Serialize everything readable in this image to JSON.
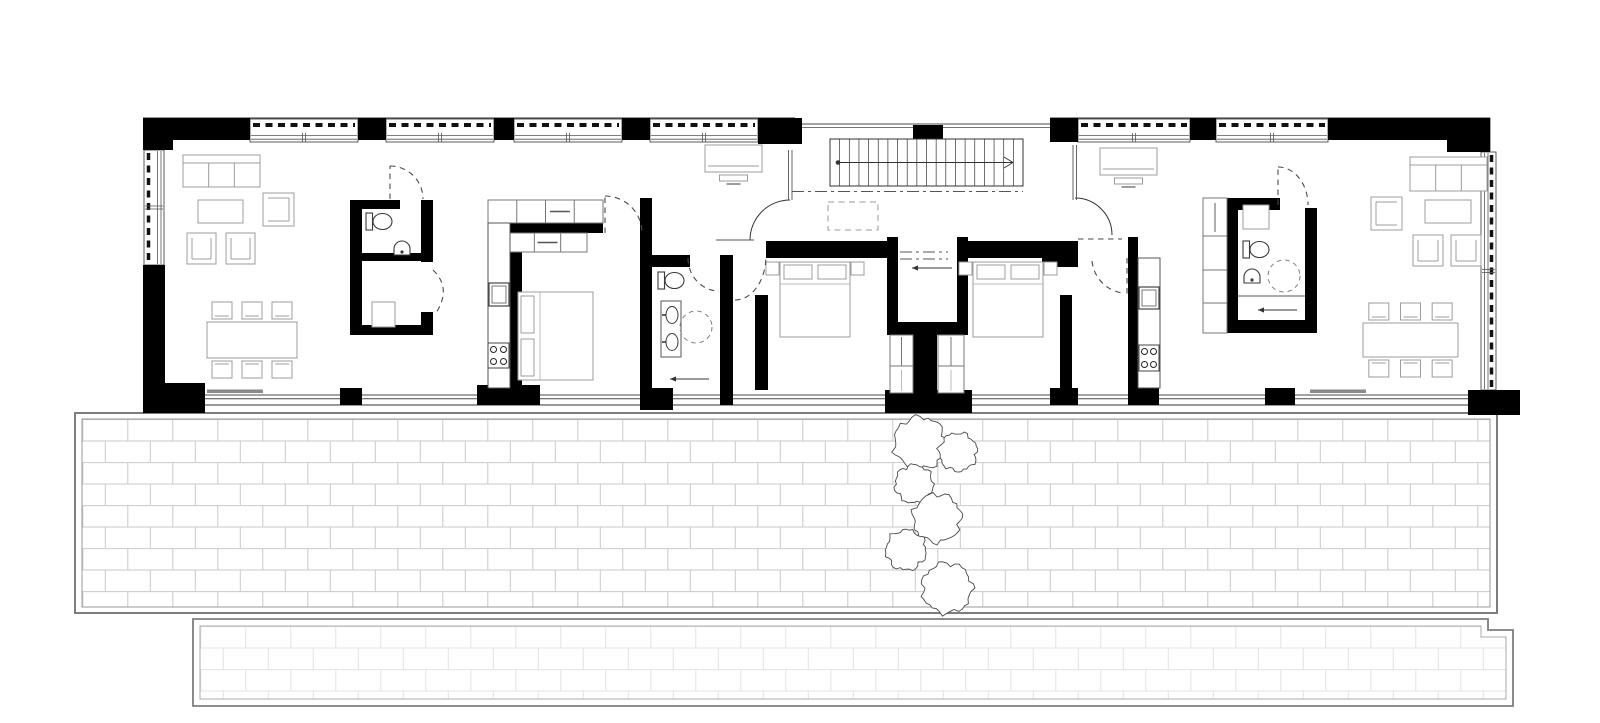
{
  "document": {
    "title": "Ground floor plan — two-unit bar building with brick terrace and trees",
    "drawing_style": "black poché walls, white floor, gray furniture linework, no text labels",
    "rooms": [
      "living-dining-west",
      "wc-west",
      "storage-west",
      "kitchen-west",
      "bedroom-west",
      "bathroom-west",
      "bedroom-center-west",
      "entry-hall",
      "staircase",
      "bedroom-center-east",
      "kitchen-east",
      "bathroom-east",
      "wardrobe-east",
      "living-dining-east",
      "terrace",
      "lower-terrace"
    ]
  },
  "canvas": {
    "width": 1600,
    "height": 723,
    "background": "#ffffff"
  },
  "palette": {
    "wall": "#000000",
    "edge": "#333333",
    "glass": "#4a4a4a",
    "thin": "#555555",
    "furniture": "#9c9c9c",
    "furnitureLight": "#bbbbbb",
    "fixture": "#3a3a3a",
    "cabinet": "#777777",
    "doorDash": "#4a4a4a",
    "dashdot": "#555555",
    "paveBorder": "#7d7d7d",
    "paveBorderLight": "#9a9a9a",
    "brickLine": "#c9c9c9",
    "brickLineLight": "#e3e3e3",
    "tree": "#4a4a4a",
    "slider": "#8a8a8a"
  },
  "building": {
    "x": 143,
    "y": 118,
    "w": 1347,
    "h": 287
  },
  "terrace": {
    "outer": [
      75,
      413,
      1422,
      200
    ],
    "inner": [
      82,
      419,
      1408,
      188
    ],
    "brick": {
      "w": 45,
      "h": 21.5
    }
  },
  "lowerTerrace": {
    "outerPath": "M193 619 H1488 V630 H1513 V706 H193 Z",
    "innerPath": "M200 626 H1481 V637 H1506 V699 H200 Z",
    "brick": {
      "w": 45,
      "h": 21.5
    }
  },
  "trees": [
    {
      "cx": 920,
      "cy": 443,
      "r": 26
    },
    {
      "cx": 958,
      "cy": 452,
      "r": 19
    },
    {
      "cx": 914,
      "cy": 484,
      "r": 19
    },
    {
      "cx": 937,
      "cy": 518,
      "r": 24
    },
    {
      "cx": 906,
      "cy": 550,
      "r": 20
    },
    {
      "cx": 947,
      "cy": 588,
      "r": 25
    }
  ],
  "walls": [
    [
      143,
      118,
      107,
      22
    ],
    [
      143,
      118,
      30,
      32
    ],
    [
      358,
      118,
      28,
      22
    ],
    [
      494,
      118,
      20,
      22
    ],
    [
      622,
      118,
      28,
      22
    ],
    [
      758,
      118,
      44,
      26
    ],
    [
      913,
      125,
      30,
      17
    ],
    [
      1050,
      118,
      28,
      24
    ],
    [
      1190,
      118,
      26,
      22
    ],
    [
      1328,
      118,
      162,
      22
    ],
    [
      1447,
      118,
      43,
      34
    ],
    [
      143,
      118,
      22,
      32
    ],
    [
      143,
      265,
      22,
      140
    ],
    [
      143,
      383,
      62,
      30
    ],
    [
      340,
      388,
      22,
      17
    ],
    [
      477,
      385,
      63,
      20
    ],
    [
      640,
      388,
      33,
      22
    ],
    [
      885,
      390,
      87,
      23
    ],
    [
      1050,
      388,
      28,
      17
    ],
    [
      1128,
      385,
      31,
      20
    ],
    [
      1265,
      388,
      30,
      17
    ],
    [
      1468,
      390,
      52,
      25
    ],
    [
      350,
      200,
      12,
      135
    ],
    [
      350,
      200,
      50,
      9
    ],
    [
      421,
      200,
      12,
      62
    ],
    [
      421,
      312,
      12,
      23
    ],
    [
      362,
      253,
      71,
      8
    ],
    [
      350,
      325,
      83,
      10
    ],
    [
      510,
      223,
      93,
      10
    ],
    [
      510,
      223,
      12,
      170
    ],
    [
      640,
      198,
      12,
      210
    ],
    [
      652,
      255,
      38,
      12
    ],
    [
      720,
      255,
      13,
      150
    ],
    [
      766,
      241,
      124,
      17
    ],
    [
      755,
      295,
      13,
      95
    ],
    [
      887,
      237,
      11,
      98
    ],
    [
      957,
      237,
      11,
      98
    ],
    [
      887,
      322,
      81,
      13
    ],
    [
      913,
      335,
      24,
      58
    ],
    [
      958,
      241,
      120,
      17
    ],
    [
      1042,
      255,
      36,
      12
    ],
    [
      1060,
      295,
      12,
      95
    ],
    [
      1128,
      237,
      10,
      150
    ],
    [
      1227,
      198,
      53,
      12
    ],
    [
      1227,
      208,
      11,
      112
    ],
    [
      1305,
      208,
      12,
      125
    ],
    [
      1227,
      320,
      90,
      13
    ]
  ],
  "windowsTop": [
    [
      250,
      358
    ],
    [
      386,
      494
    ],
    [
      514,
      622
    ],
    [
      650,
      758
    ],
    [
      1078,
      1190
    ],
    [
      1216,
      1328
    ]
  ],
  "hallGlazing": {
    "x1": 795,
    "x2": 1050,
    "y1": 124,
    "y2": 127.5
  },
  "windowLeft": {
    "x": 144,
    "y": 150,
    "w": 20,
    "h": 115
  },
  "windowRight": {
    "x": 1481,
    "y": 152,
    "w": 15,
    "h": 238
  },
  "bottomGlazing": {
    "x1": 165,
    "x2": 1468,
    "y1": 395,
    "y2": 398.8
  },
  "sliders": [
    {
      "x": 207,
      "y": 389.5,
      "w": 56
    },
    {
      "x": 1310,
      "y": 389.5,
      "w": 56
    }
  ],
  "stairs": {
    "x": 830,
    "y": 139,
    "w": 193,
    "h": 47,
    "risers": 20,
    "walkY": 162.5,
    "direction": "up-to-right"
  },
  "underStairOutline": [
    828,
    202,
    50,
    28
  ],
  "partitions": [
    {
      "x": 788.5,
      "y1": 150,
      "y2": 200
    },
    {
      "x": 792,
      "y1": 150,
      "y2": 200
    },
    {
      "x": 1073,
      "y1": 145,
      "y2": 200
    },
    {
      "x": 1076.5,
      "y1": 145,
      "y2": 200
    }
  ],
  "entryArcs": [
    {
      "name": "entry-door-west",
      "path": "M790 200 A40 40 0 0 0 750 240"
    },
    {
      "name": "entry-door-east",
      "path": "M1075 198 A37 37 0 0 1 1112 235"
    }
  ],
  "doors": [
    {
      "name": "door-wc-west",
      "arc": "M390 166 A33 33 0 0 1 423 199",
      "leaf": "M390 199 L390 166"
    },
    {
      "name": "door-storage-west",
      "arc": "M433 270 Q452 288 436 313"
    },
    {
      "name": "door-bedroom-west",
      "arc": "M605 196 A37 37 0 0 1 642 233",
      "leaf": "M605 233 L605 196"
    },
    {
      "name": "door-bath-west",
      "arc": "M688 258 A31 33 0 0 0 719 291"
    },
    {
      "name": "door-bedroom-center-west",
      "arc": "M735 300 A31 44 0 0 0 766 256"
    },
    {
      "name": "door-bedroom-center-east",
      "arc": "M1092 261 A36 36 0 0 0 1122 293",
      "leaf": "M1127 258 L1127 296"
    },
    {
      "name": "threshold-corridor-east",
      "arc": "M1078 239 L1122 239"
    },
    {
      "name": "door-bath-east",
      "arc": "M1278 167 A30 38 0 0 1 1308 205",
      "leaf": "M1278 205 L1278 167"
    }
  ],
  "dashDot": [
    "M792 191.5 L1023 191.5",
    "M900 252 L948 252",
    "M900 259 L948 259"
  ],
  "arrows": [
    {
      "name": "entry-arrow",
      "x1": 952,
      "y1": 268,
      "x2": 912,
      "y2": 268
    },
    {
      "name": "laundry-arrow-west",
      "x1": 709,
      "y1": 379,
      "x2": 670,
      "y2": 379
    },
    {
      "name": "laundry-arrow-east",
      "x1": 1297,
      "y1": 310,
      "x2": 1258,
      "y2": 310
    }
  ],
  "decorLines": [
    {
      "x1": 716,
      "y1": 240,
      "x2": 754,
      "y2": 240
    },
    {
      "x1": 1238,
      "y1": 296,
      "x2": 1305,
      "y2": 296
    }
  ],
  "furniture": [
    {
      "name": "sofa-west",
      "type": "sofa",
      "x": 183,
      "y": 155,
      "w": 77,
      "h": 32
    },
    {
      "name": "coffee-table-west",
      "type": "rect",
      "x": 198,
      "y": 200,
      "w": 45,
      "h": 23
    },
    {
      "name": "armchair-west-1",
      "type": "armchair",
      "x": 263,
      "y": 193,
      "w": 31,
      "h": 33,
      "open": "left"
    },
    {
      "name": "armchair-west-2",
      "type": "armchair",
      "x": 187,
      "y": 233,
      "w": 29,
      "h": 31,
      "open": "up"
    },
    {
      "name": "armchair-west-3",
      "type": "armchair",
      "x": 226,
      "y": 233,
      "w": 29,
      "h": 31,
      "open": "up"
    },
    {
      "name": "dining-set-west",
      "type": "dining",
      "x": 207,
      "y": 322,
      "w": 90,
      "h": 36
    },
    {
      "name": "toilet-wc-west",
      "type": "toilet",
      "x": 366,
      "y": 213
    },
    {
      "name": "basin-wc-west",
      "type": "sink",
      "cx": 402,
      "cy": 249
    },
    {
      "name": "storage-box-west",
      "type": "rect",
      "x": 372,
      "y": 302,
      "w": 23,
      "h": 25
    },
    {
      "name": "kitchen-upper-cabinets-west",
      "type": "cabinets",
      "x": 488,
      "y": 200,
      "w": 115,
      "h": 23,
      "cells": 4
    },
    {
      "name": "wardrobe-bedroom-west",
      "type": "cabinets",
      "x": 508,
      "y": 233,
      "w": 79,
      "h": 19,
      "cells": 3
    },
    {
      "name": "kitchen-counter-west",
      "type": "counter",
      "x": 488,
      "y": 223,
      "w": 22,
      "h": 165
    },
    {
      "name": "oven-west",
      "type": "appliance",
      "x": 489,
      "y": 283,
      "w": 20,
      "h": 23
    },
    {
      "name": "cooktop-west",
      "type": "stove",
      "x": 488,
      "y": 343,
      "w": 21,
      "h": 25
    },
    {
      "name": "bed-west",
      "type": "bed",
      "x": 518,
      "y": 292,
      "w": 75,
      "h": 88,
      "head": "left"
    },
    {
      "name": "toilet-bath-west",
      "type": "toilet",
      "x": 658,
      "y": 272
    },
    {
      "name": "vanity-bath-west",
      "type": "vanity",
      "x": 661,
      "y": 301,
      "w": 20,
      "h": 56
    },
    {
      "name": "shower-bath-west",
      "type": "shower",
      "cx": 696,
      "cy": 327,
      "r": 16
    },
    {
      "name": "desk-west",
      "type": "desk",
      "x": 705,
      "y": 145,
      "w": 57,
      "h": 27
    },
    {
      "name": "bed-center-west",
      "type": "bed",
      "x": 780,
      "y": 262,
      "w": 70,
      "h": 75,
      "head": "top"
    },
    {
      "name": "nightstand-cw-1",
      "type": "rect",
      "x": 766,
      "y": 262,
      "w": 13,
      "h": 13
    },
    {
      "name": "nightstand-cw-2",
      "type": "rect",
      "x": 851,
      "y": 262,
      "w": 13,
      "h": 13
    },
    {
      "name": "closet-center-west",
      "type": "closet",
      "x": 890,
      "y": 335,
      "w": 23,
      "h": 58
    },
    {
      "name": "closet-center-east",
      "type": "closet",
      "x": 938,
      "y": 335,
      "w": 26,
      "h": 58
    },
    {
      "name": "bed-center-east",
      "type": "bed",
      "x": 973,
      "y": 262,
      "w": 70,
      "h": 75,
      "head": "top"
    },
    {
      "name": "nightstand-ce-1",
      "type": "rect",
      "x": 959,
      "y": 262,
      "w": 13,
      "h": 13
    },
    {
      "name": "nightstand-ce-2",
      "type": "rect",
      "x": 1044,
      "y": 262,
      "w": 13,
      "h": 13
    },
    {
      "name": "desk-east",
      "type": "desk",
      "x": 1100,
      "y": 148,
      "w": 57,
      "h": 27
    },
    {
      "name": "kitchen-counter-east",
      "type": "counter",
      "x": 1138,
      "y": 258,
      "w": 22,
      "h": 130
    },
    {
      "name": "oven-east",
      "type": "appliance",
      "x": 1139,
      "y": 287,
      "w": 20,
      "h": 22
    },
    {
      "name": "cooktop-east",
      "type": "stove",
      "x": 1139,
      "y": 345,
      "w": 20,
      "h": 26
    },
    {
      "name": "tall-closet-east",
      "type": "closetTall",
      "x": 1203,
      "y": 198,
      "w": 24,
      "h": 135
    },
    {
      "name": "cabinet-bath-east",
      "type": "rect",
      "x": 1243,
      "y": 205,
      "w": 26,
      "h": 24
    },
    {
      "name": "toilet-bath-east",
      "type": "toilet",
      "x": 1243,
      "y": 241
    },
    {
      "name": "basin-bath-east",
      "type": "sink",
      "cx": 1252,
      "cy": 277
    },
    {
      "name": "shower-bath-east",
      "type": "shower",
      "cx": 1284,
      "cy": 276,
      "r": 16
    },
    {
      "name": "sofa-east",
      "type": "sofa",
      "x": 1410,
      "y": 157,
      "w": 77,
      "h": 34
    },
    {
      "name": "armchair-east-1",
      "type": "armchair",
      "x": 1371,
      "y": 197,
      "w": 31,
      "h": 33,
      "open": "right"
    },
    {
      "name": "coffee-table-east",
      "type": "rect",
      "x": 1425,
      "y": 200,
      "w": 46,
      "h": 23
    },
    {
      "name": "armchair-east-2",
      "type": "armchair",
      "x": 1413,
      "y": 235,
      "w": 30,
      "h": 31,
      "open": "up"
    },
    {
      "name": "armchair-east-3",
      "type": "armchair",
      "x": 1451,
      "y": 235,
      "w": 30,
      "h": 31,
      "open": "up"
    },
    {
      "name": "dining-set-east",
      "type": "dining",
      "x": 1363,
      "y": 323,
      "w": 95,
      "h": 34
    }
  ]
}
